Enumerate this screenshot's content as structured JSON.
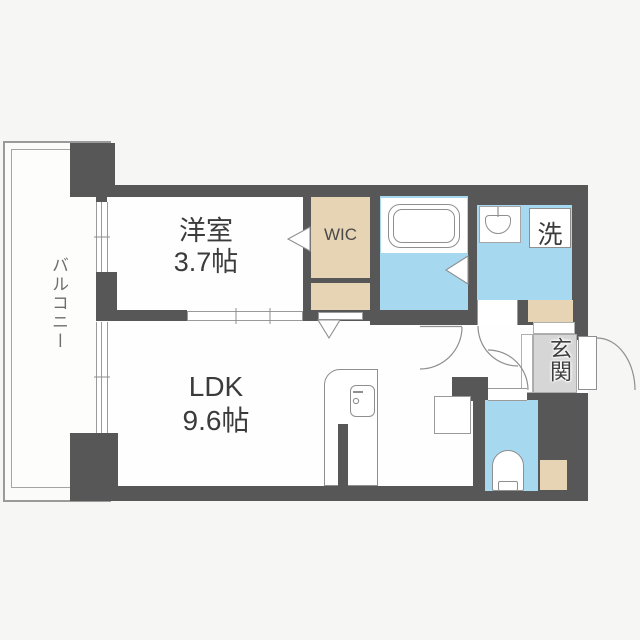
{
  "floorplan": {
    "rooms": {
      "balcony": {
        "label": "バルコニー"
      },
      "western_room": {
        "label": "洋室",
        "area": "3.7帖"
      },
      "ldk": {
        "label": "LDK",
        "area": "9.6帖"
      },
      "wic": {
        "label": "WIC"
      },
      "washer": {
        "label": "洗"
      },
      "entrance": {
        "label": "玄関"
      }
    },
    "fixtures": [
      "bathtub-icon",
      "washbasin-icon",
      "toilet-icon",
      "kitchen-counter-icon",
      "refrigerator-space",
      "door-swing-arc",
      "folding-door-triangle",
      "sliding-door",
      "window"
    ],
    "colors": {
      "wall": "#575757",
      "wet_area": "#a6d8f0",
      "storage": "#e7d4b5",
      "entrance_floor": "#d6d6d6",
      "floor": "#fefefe",
      "background": "#f6f6f5",
      "outline": "#8f8f8f",
      "text": "#3b3b3b",
      "balcony_text": "#6e6e6e"
    }
  }
}
